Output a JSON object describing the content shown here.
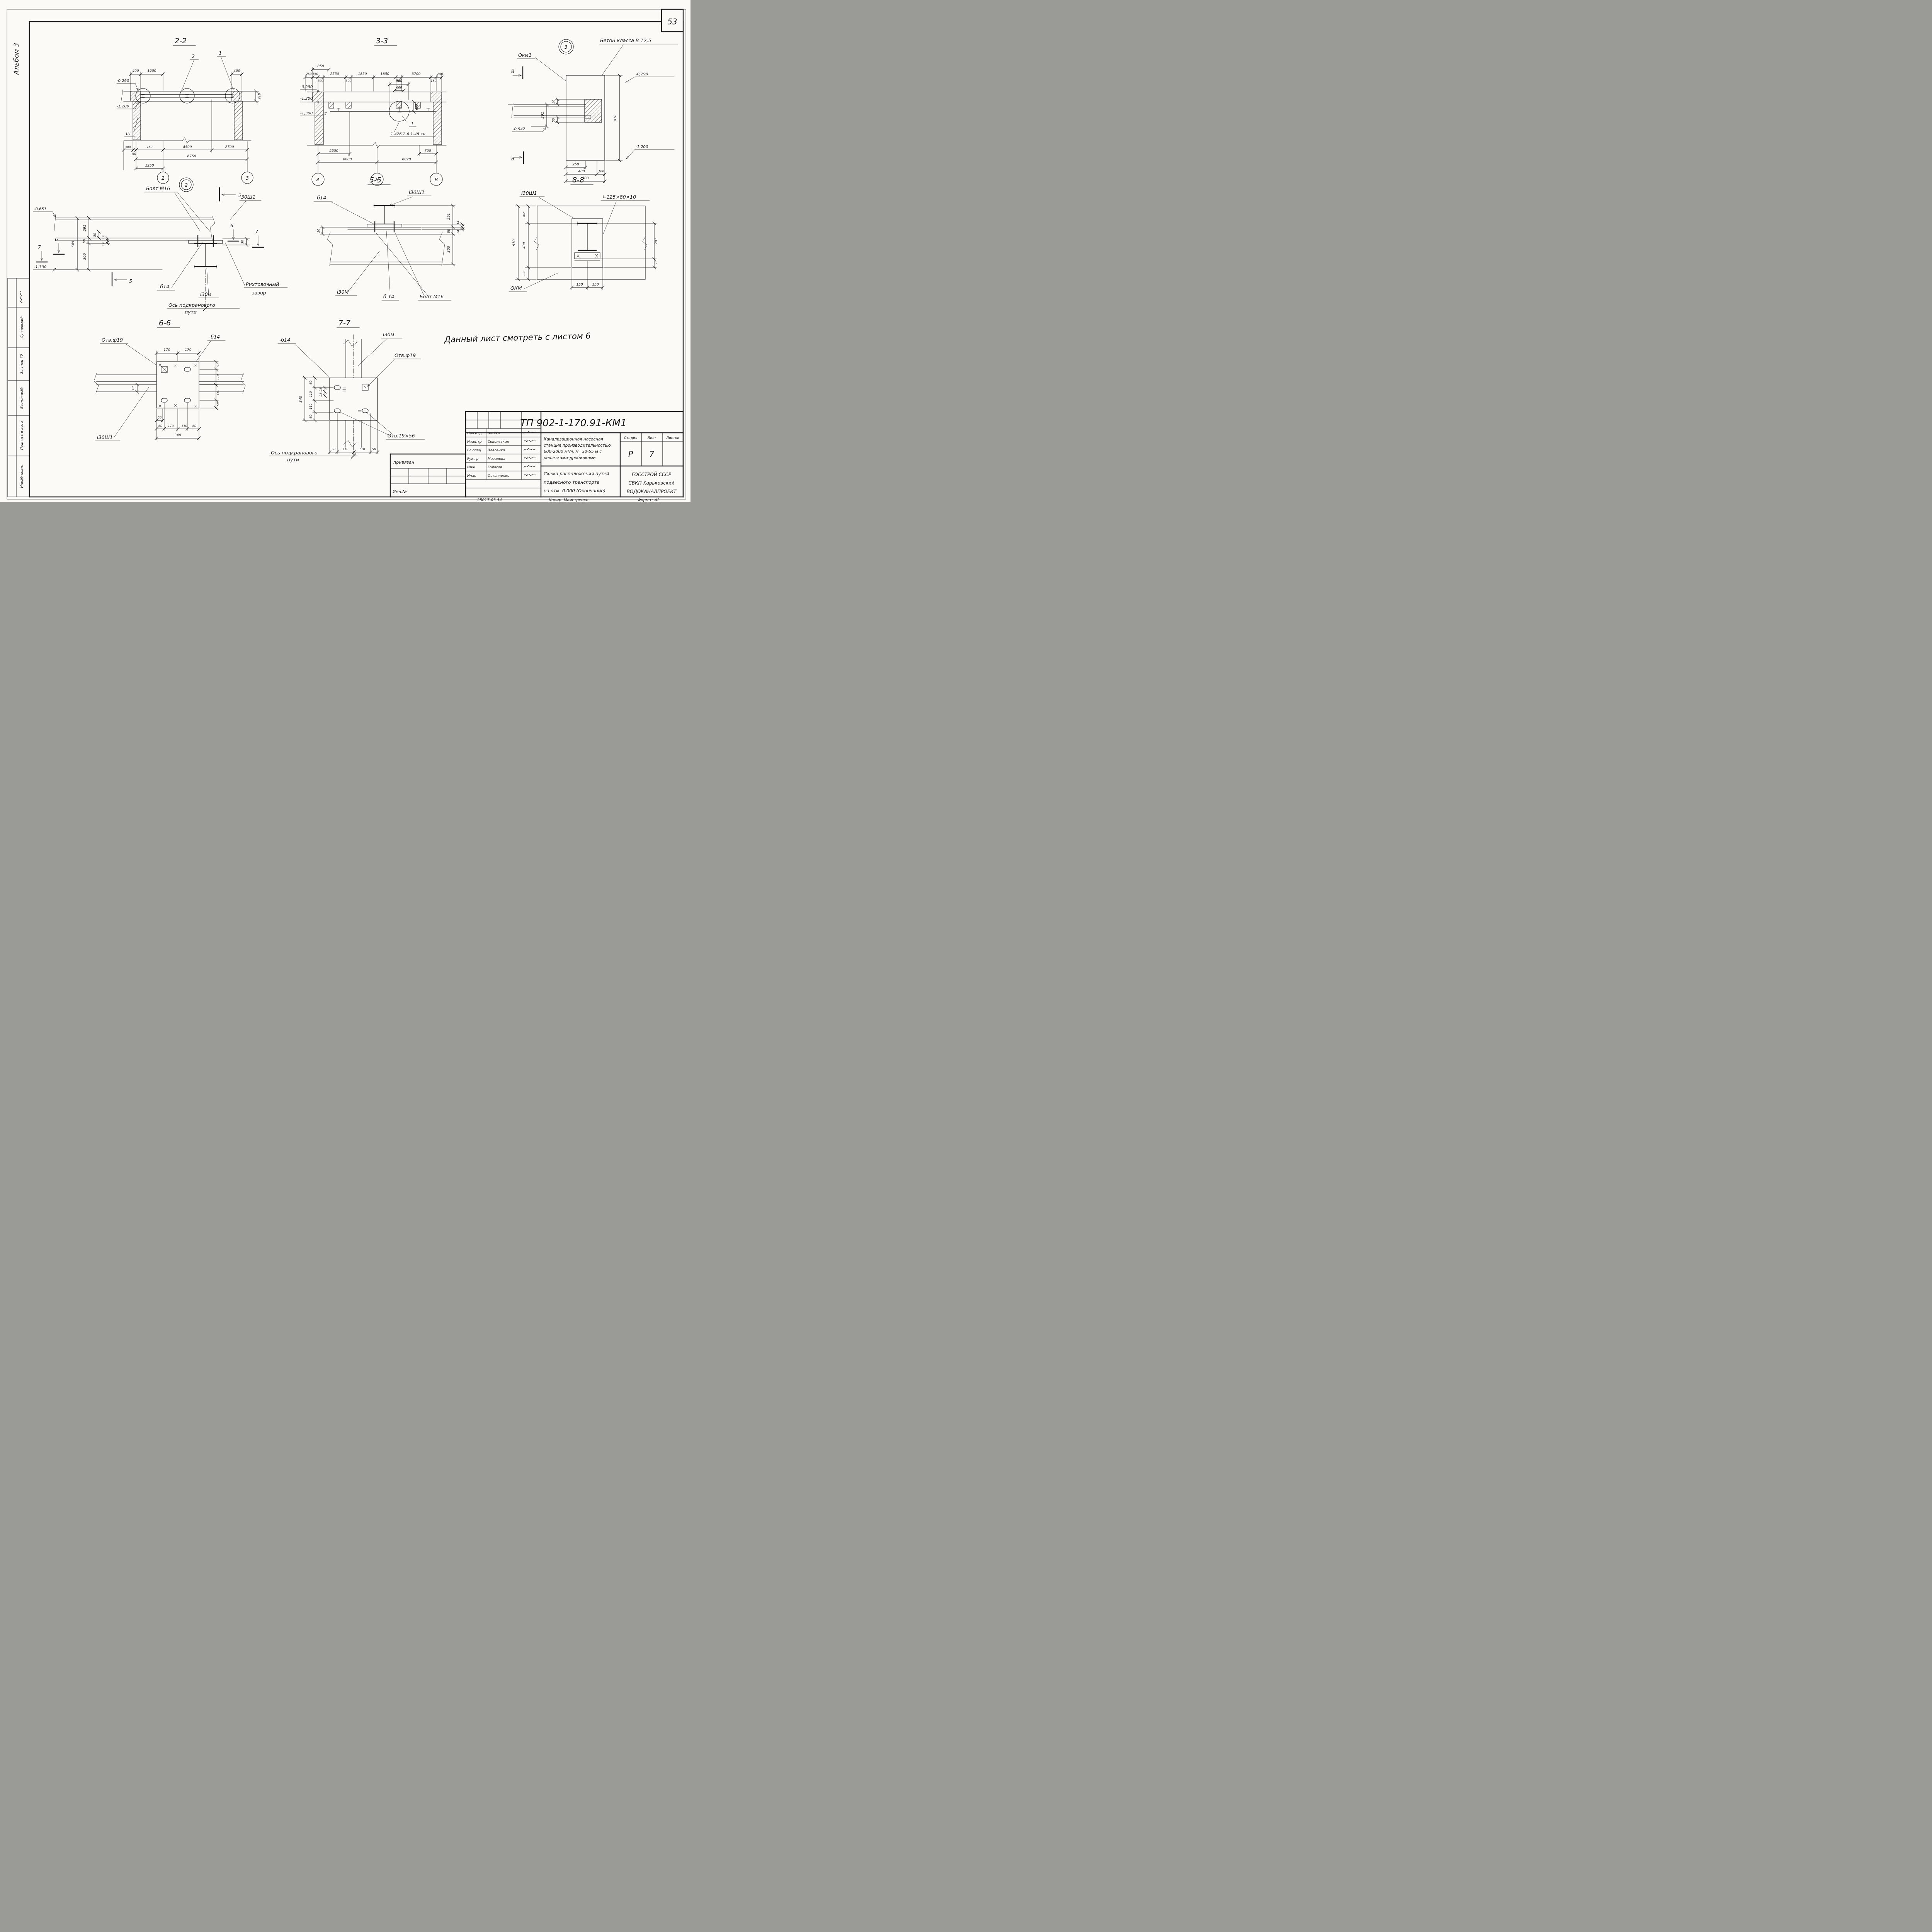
{
  "page": {
    "sheet_number": "53",
    "album": "Альбом 3",
    "note": "Данный лист  смотреть  с листом 6"
  },
  "sidebar": {
    "name": "Лучновский",
    "dept": "За.спец 70",
    "vzam": "Взам.инв.№",
    "podp": "Подпись и дата",
    "inv": "Инв.№ подл."
  },
  "s22": {
    "title": "2-2",
    "c2": "2",
    "c1": "1",
    "e1": "-0,290",
    "e2": "-1,200",
    "in": "Iн",
    "d400l": "400",
    "d1250t": "1250",
    "d400r": "400",
    "d910": "910",
    "d300": "300",
    "d50": "50",
    "d750": "750",
    "d4500": "4500",
    "d2700": "2700",
    "d6750": "6750",
    "d1250b": "1250",
    "g2": "2",
    "g3": "3"
  },
  "s33": {
    "title": "3-3",
    "d850": "850",
    "t": [
      "250",
      "150",
      "300",
      "2550",
      "300",
      "1850",
      "1850",
      "300",
      "3700",
      "150",
      "250"
    ],
    "d900": "900",
    "d600a": "600",
    "d600b": "600",
    "c1": "1",
    "ref": "1.426.2-6.1-48 кн",
    "e1": "-0,290",
    "e2": "-1,200",
    "e3": "-1,300",
    "b2550": "2550",
    "b6000": "6000",
    "b6020": "6020",
    "b700": "700",
    "gA": "А",
    "gB": "Б",
    "gV": "В"
  },
  "d3": {
    "num": "3",
    "beton": "Бетон класса В 12,5",
    "okm": "Окм1",
    "cut8": "8",
    "cutV": "В",
    "e1": "-0,290",
    "e2": "-1,200",
    "e3": "-0,942",
    "d50t": "50",
    "d50b": "50",
    "d291": "291",
    "d910": "910",
    "d250": "250",
    "d400": "400",
    "d100": "100",
    "d500": "500"
  },
  "d2": {
    "num": "2",
    "bolt": "Болт М16",
    "sh": "30Ш1",
    "e1": "-0,651",
    "e2": "-1,300",
    "cut5a": "5",
    "cut5b": "5",
    "cut6l": "6",
    "cut7l": "7",
    "cut6r": "6",
    "cut7r": "7",
    "d649": "649",
    "d291": "291",
    "d58": "58",
    "d300": "300",
    "d30a": "30",
    "d14a": "14",
    "d14b": "14",
    "d30b": "30",
    "b14": "-б14",
    "i30m": "I30м",
    "gap1": "Рихтовочный",
    "gap2": "зазор",
    "axis1": "Ось подкранового",
    "axis2": "пути"
  },
  "s55": {
    "title": "5-5",
    "b14": "-б14",
    "i30sh": "I30Ш1",
    "d30": "30",
    "d291": "291",
    "d14a": "14",
    "d14b": "14",
    "d58": "58",
    "d300": "300",
    "i30m": "I30М",
    "b14b": "б-14",
    "bolt": "Болт М16"
  },
  "s88": {
    "title": "8-8",
    "i30sh": "I30Ш1",
    "angle": "∟125×80×10",
    "okm": "ОКМ",
    "d910": "910",
    "d302": "302",
    "d400": "400",
    "d208": "208",
    "d291": "291",
    "d50": "50",
    "d150a": "150",
    "d150b": "150"
  },
  "s66": {
    "title": "6-6",
    "otv": "Отв.ф19",
    "b14": "-б14",
    "i30sh": "I30Ш1",
    "d170a": "170",
    "d170b": "170",
    "d50t": "50",
    "d110a": "110",
    "d110b": "110",
    "d50b": "50",
    "d19": "19",
    "d56": "56",
    "d60a": "60",
    "d110c": "110",
    "d110d": "110",
    "d60b": "60",
    "d340": "340"
  },
  "s77": {
    "title": "7-7",
    "b14": "-б14",
    "i30m": "I30м",
    "otv19": "Отв.ф19",
    "otv1956": "Отв.19×56",
    "d60t": "60",
    "d110a": "110",
    "d110b": "110",
    "d60b": "60",
    "d340": "340",
    "d28a": "28",
    "d28b": "28",
    "d50a": "50",
    "d110c": "110",
    "d110d": "110",
    "d50c": "50",
    "axis1": "Ось подкранового",
    "axis2": "пути"
  },
  "tb": {
    "doc": "ТП 902-1-170.91-КМ1",
    "priv": "привязан",
    "inv": "Инв.№",
    "roles": [
      "Нач.отд",
      "Н.контр.",
      "Гл.спец.",
      "Рук.гр.",
      "Инж.",
      "Инж."
    ],
    "names": [
      "Шейко",
      "Сокольская",
      "Власенко",
      "Мазалова",
      "Голосов",
      "Остапченко"
    ],
    "prj1": "Канализационная насосная",
    "prj2": "станция производительностью",
    "prj3": "600-2000 м³/ч, Н=30-55 м  с",
    "prj4": "решетками-дробилками",
    "stadia": "Стадия",
    "list": "Лист",
    "listov": "Листов",
    "stadia_v": "Р",
    "list_v": "7",
    "ttl1": "Схема расположения путей",
    "ttl2": "подвесного транспорта",
    "ttl3": "на отм. 0.000 (Окончание)",
    "org1": "ГОССТРОЙ СССР",
    "org2": "СВКП Харьковский",
    "org3": "ВОДОКАНАЛПРОЕКТ",
    "code": "25017-03  54",
    "kopir": "Копир. Маистренко",
    "format": "Формат А2"
  }
}
